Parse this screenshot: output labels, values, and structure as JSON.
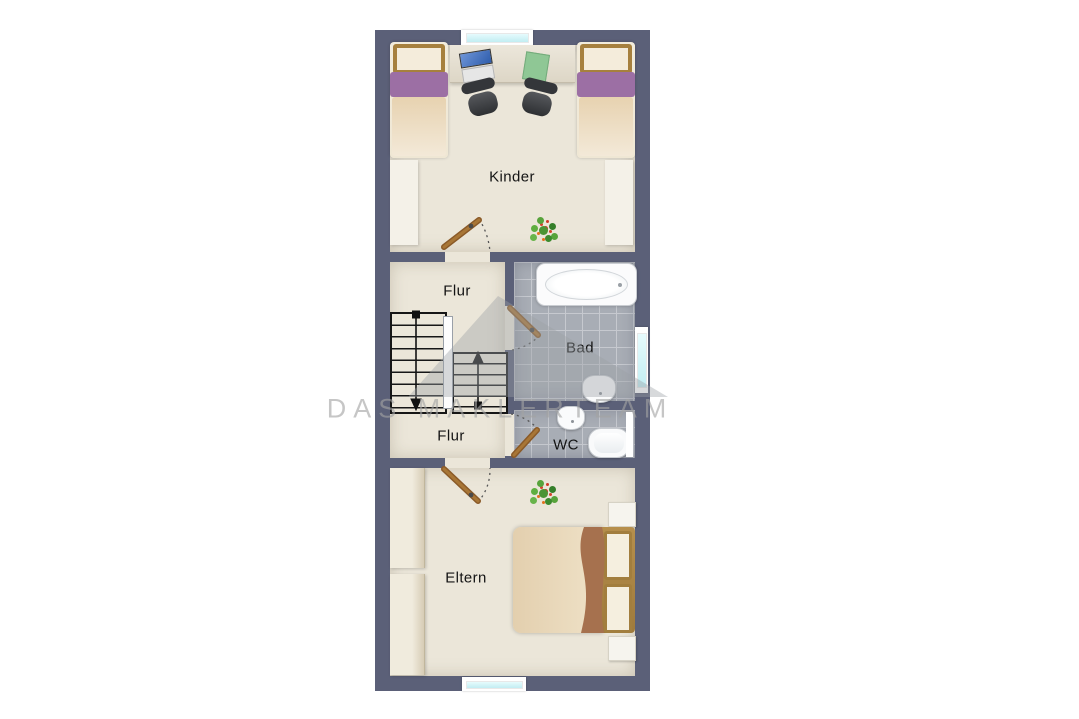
{
  "watermark": {
    "text": "DAS MAKLERTEAM"
  },
  "rooms": {
    "kinder": {
      "label": "Kinder"
    },
    "flur_top": {
      "label": "Flur"
    },
    "bad": {
      "label": "Bad"
    },
    "wc": {
      "label": "WC"
    },
    "flur_bottom": {
      "label": "Flur"
    },
    "eltern": {
      "label": "Eltern"
    }
  },
  "furniture_icons": {
    "kinder": [
      "single-bed",
      "single-bed",
      "desk",
      "laptop",
      "office-chair",
      "office-chair",
      "plant",
      "door"
    ],
    "flur": [
      "staircase-up",
      "staircase-down",
      "door"
    ],
    "bad": [
      "bathtub",
      "sink",
      "window",
      "door"
    ],
    "wc": [
      "sink",
      "toilet",
      "door"
    ],
    "eltern": [
      "wardrobe",
      "wardrobe",
      "double-bed",
      "nightstand",
      "nightstand",
      "plant",
      "door"
    ]
  },
  "colors": {
    "wall": "#5b6078",
    "floor": "#ebe6d9",
    "tile": "#a8adb5",
    "window_glass": "#cdeef2",
    "wood_door": "#9c6b30",
    "watermark_gray": "#a3a3a3"
  }
}
